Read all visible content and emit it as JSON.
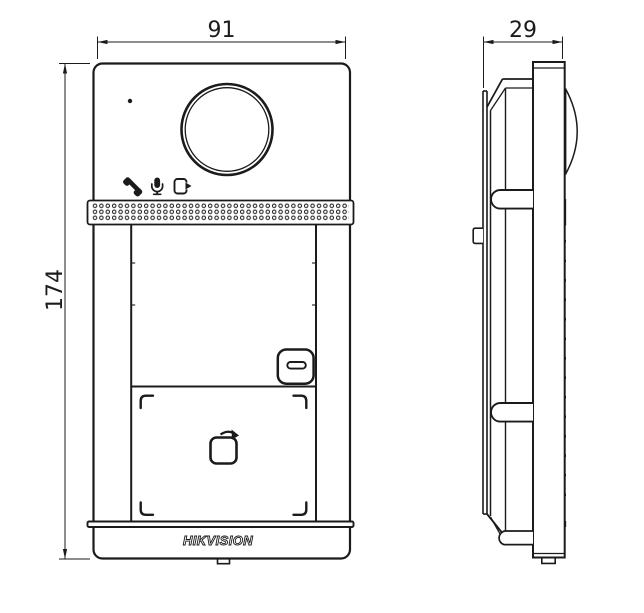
{
  "drawing": {
    "background": "#ffffff",
    "line_color": "#1b1b1b",
    "brand_logo": "HIKVISION",
    "dimensions": {
      "width": "91",
      "height": "174",
      "depth": "29"
    },
    "front_view": {
      "icons": [
        "phone-icon",
        "microphone-icon",
        "door-exit-icon",
        "tap-card-icon"
      ],
      "features": [
        "microphone-hole",
        "camera-lens",
        "speaker-grille",
        "call-button",
        "card-reader-zone",
        "brand-logo",
        "bottom-cable-notch"
      ]
    },
    "side_view": {
      "features": [
        "camera-dome-profile",
        "mounting-plate",
        "mounting-clip-top",
        "mounting-clip-bottom",
        "wall-bracket-tab",
        "bottom-cable-notch"
      ]
    }
  }
}
